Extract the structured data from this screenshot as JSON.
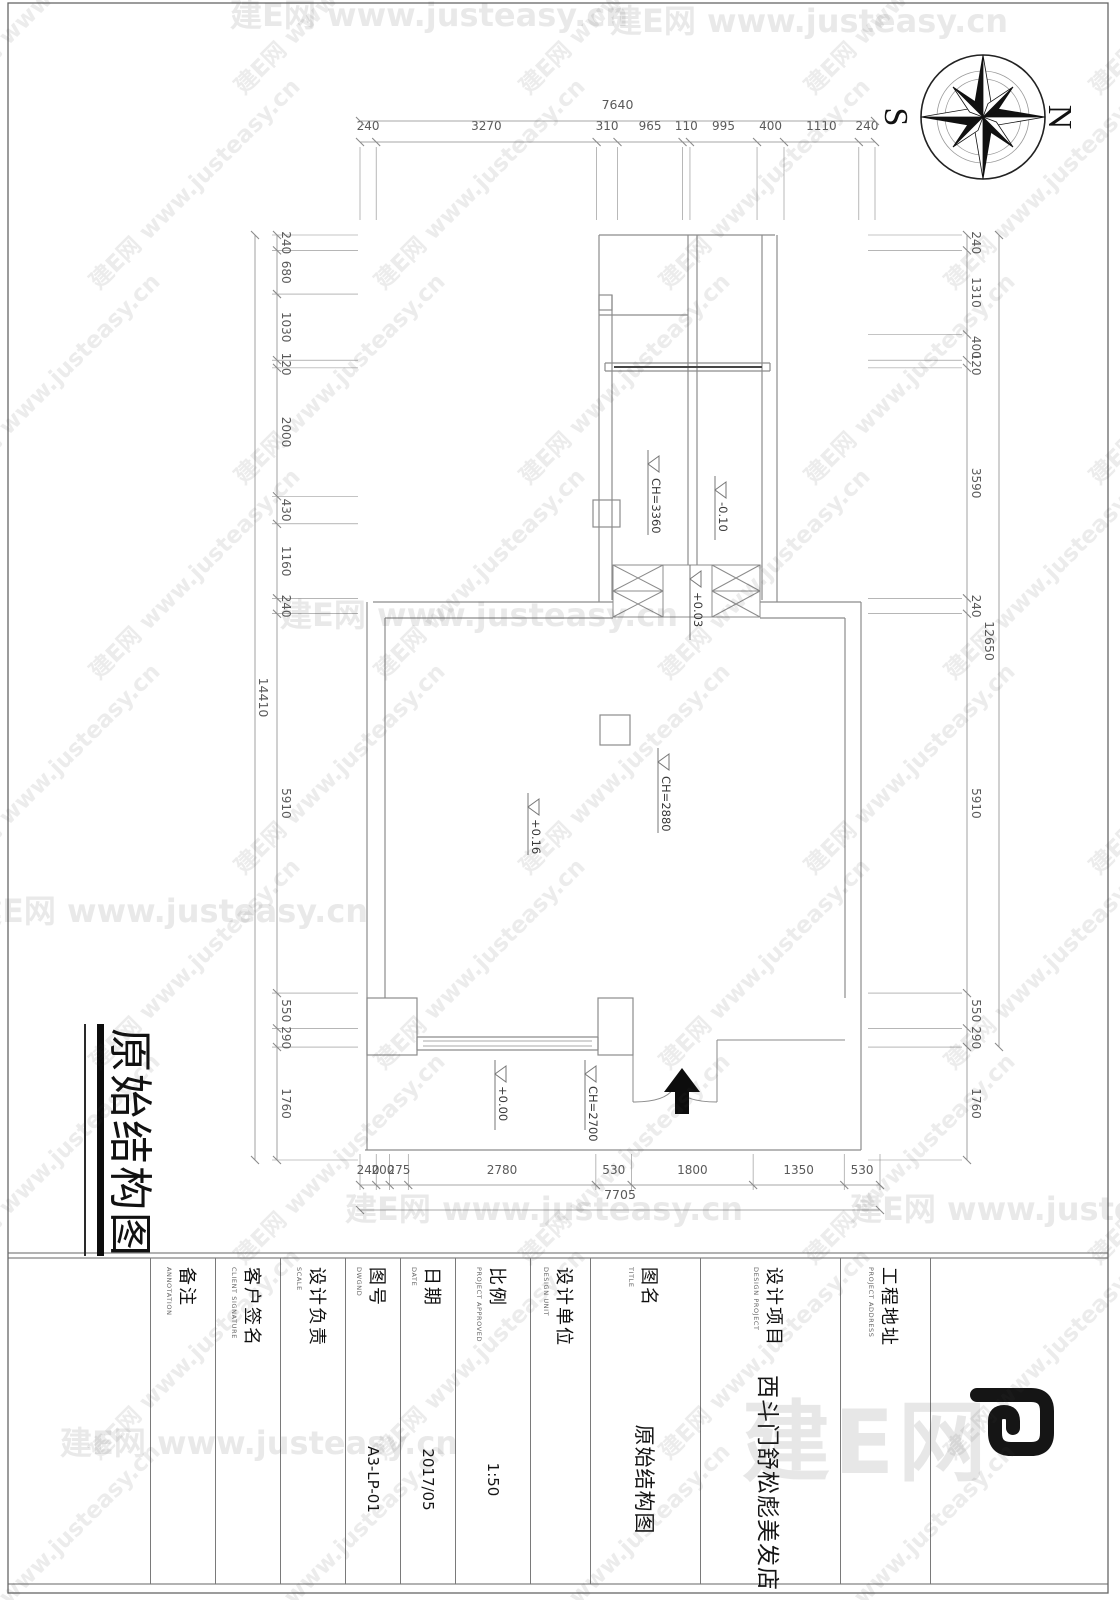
{
  "watermark": {
    "tile_text": "建E网 www.justeasy.cn",
    "brand_text": "建E网"
  },
  "compass": {
    "north": "N",
    "south": "S"
  },
  "drawing_title": "原始结构图",
  "plan": {
    "levels": [
      {
        "name": "ceiling-height-back-room",
        "value": "CH=3360"
      },
      {
        "name": "floor-level-back-room",
        "value": "-0.10"
      },
      {
        "name": "floor-level-passage",
        "value": "+0.03"
      },
      {
        "name": "ceiling-height-main-room",
        "value": "CH=2880"
      },
      {
        "name": "floor-level-main-room",
        "value": "+0.16"
      },
      {
        "name": "floor-level-entry",
        "value": "+0.00"
      },
      {
        "name": "ceiling-height-entry",
        "value": "CH=2700"
      }
    ]
  },
  "dims": {
    "left": {
      "overall": "7640",
      "segments": [
        "240",
        "3270",
        "310",
        "965",
        "110",
        "995",
        "400",
        "1110",
        "240"
      ]
    },
    "top": {
      "overall": "12650",
      "segments": [
        "240",
        "1310",
        "400",
        "120",
        "3590",
        "240",
        "5910",
        "550",
        "290",
        "1760"
      ]
    },
    "bottom": {
      "overall": "14410",
      "segments": [
        "240",
        "680",
        "1030",
        "120",
        "2000",
        "430",
        "1160",
        "240",
        "5910",
        "550",
        "290",
        "1760"
      ]
    },
    "right": {
      "overall": "7705",
      "segments": [
        "240",
        "200",
        "275",
        "2780",
        "530",
        "1800",
        "1350",
        "530"
      ]
    }
  },
  "title_block": {
    "cells": [
      {
        "label": "",
        "caption": "",
        "value": "",
        "logo": true
      },
      {
        "label": "工程地址",
        "caption": "PROJECT ADDRESS",
        "value": ""
      },
      {
        "label": "设计项目",
        "caption": "DESIGN PROJECT",
        "value": "西斗门舒松彪美发店"
      },
      {
        "label": "图名",
        "caption": "TITLE",
        "value": "原始结构图"
      },
      {
        "label": "设计单位",
        "caption": "DESIGN UNIT",
        "value": ""
      },
      {
        "label": "比例",
        "caption": "PROJECT APPROVED",
        "value": "1:50"
      },
      {
        "label": "日期",
        "caption": "DATE",
        "value": "2017/05"
      },
      {
        "label": "图号",
        "caption": "DWGND",
        "value": "A3-LP-01"
      },
      {
        "label": "设计负责",
        "caption": "SCALE",
        "value": ""
      },
      {
        "label": "客户签名",
        "caption": "CLIENT SIGNATURE",
        "value": ""
      },
      {
        "label": "备注",
        "caption": "ANNOTATION",
        "value": ""
      }
    ]
  }
}
